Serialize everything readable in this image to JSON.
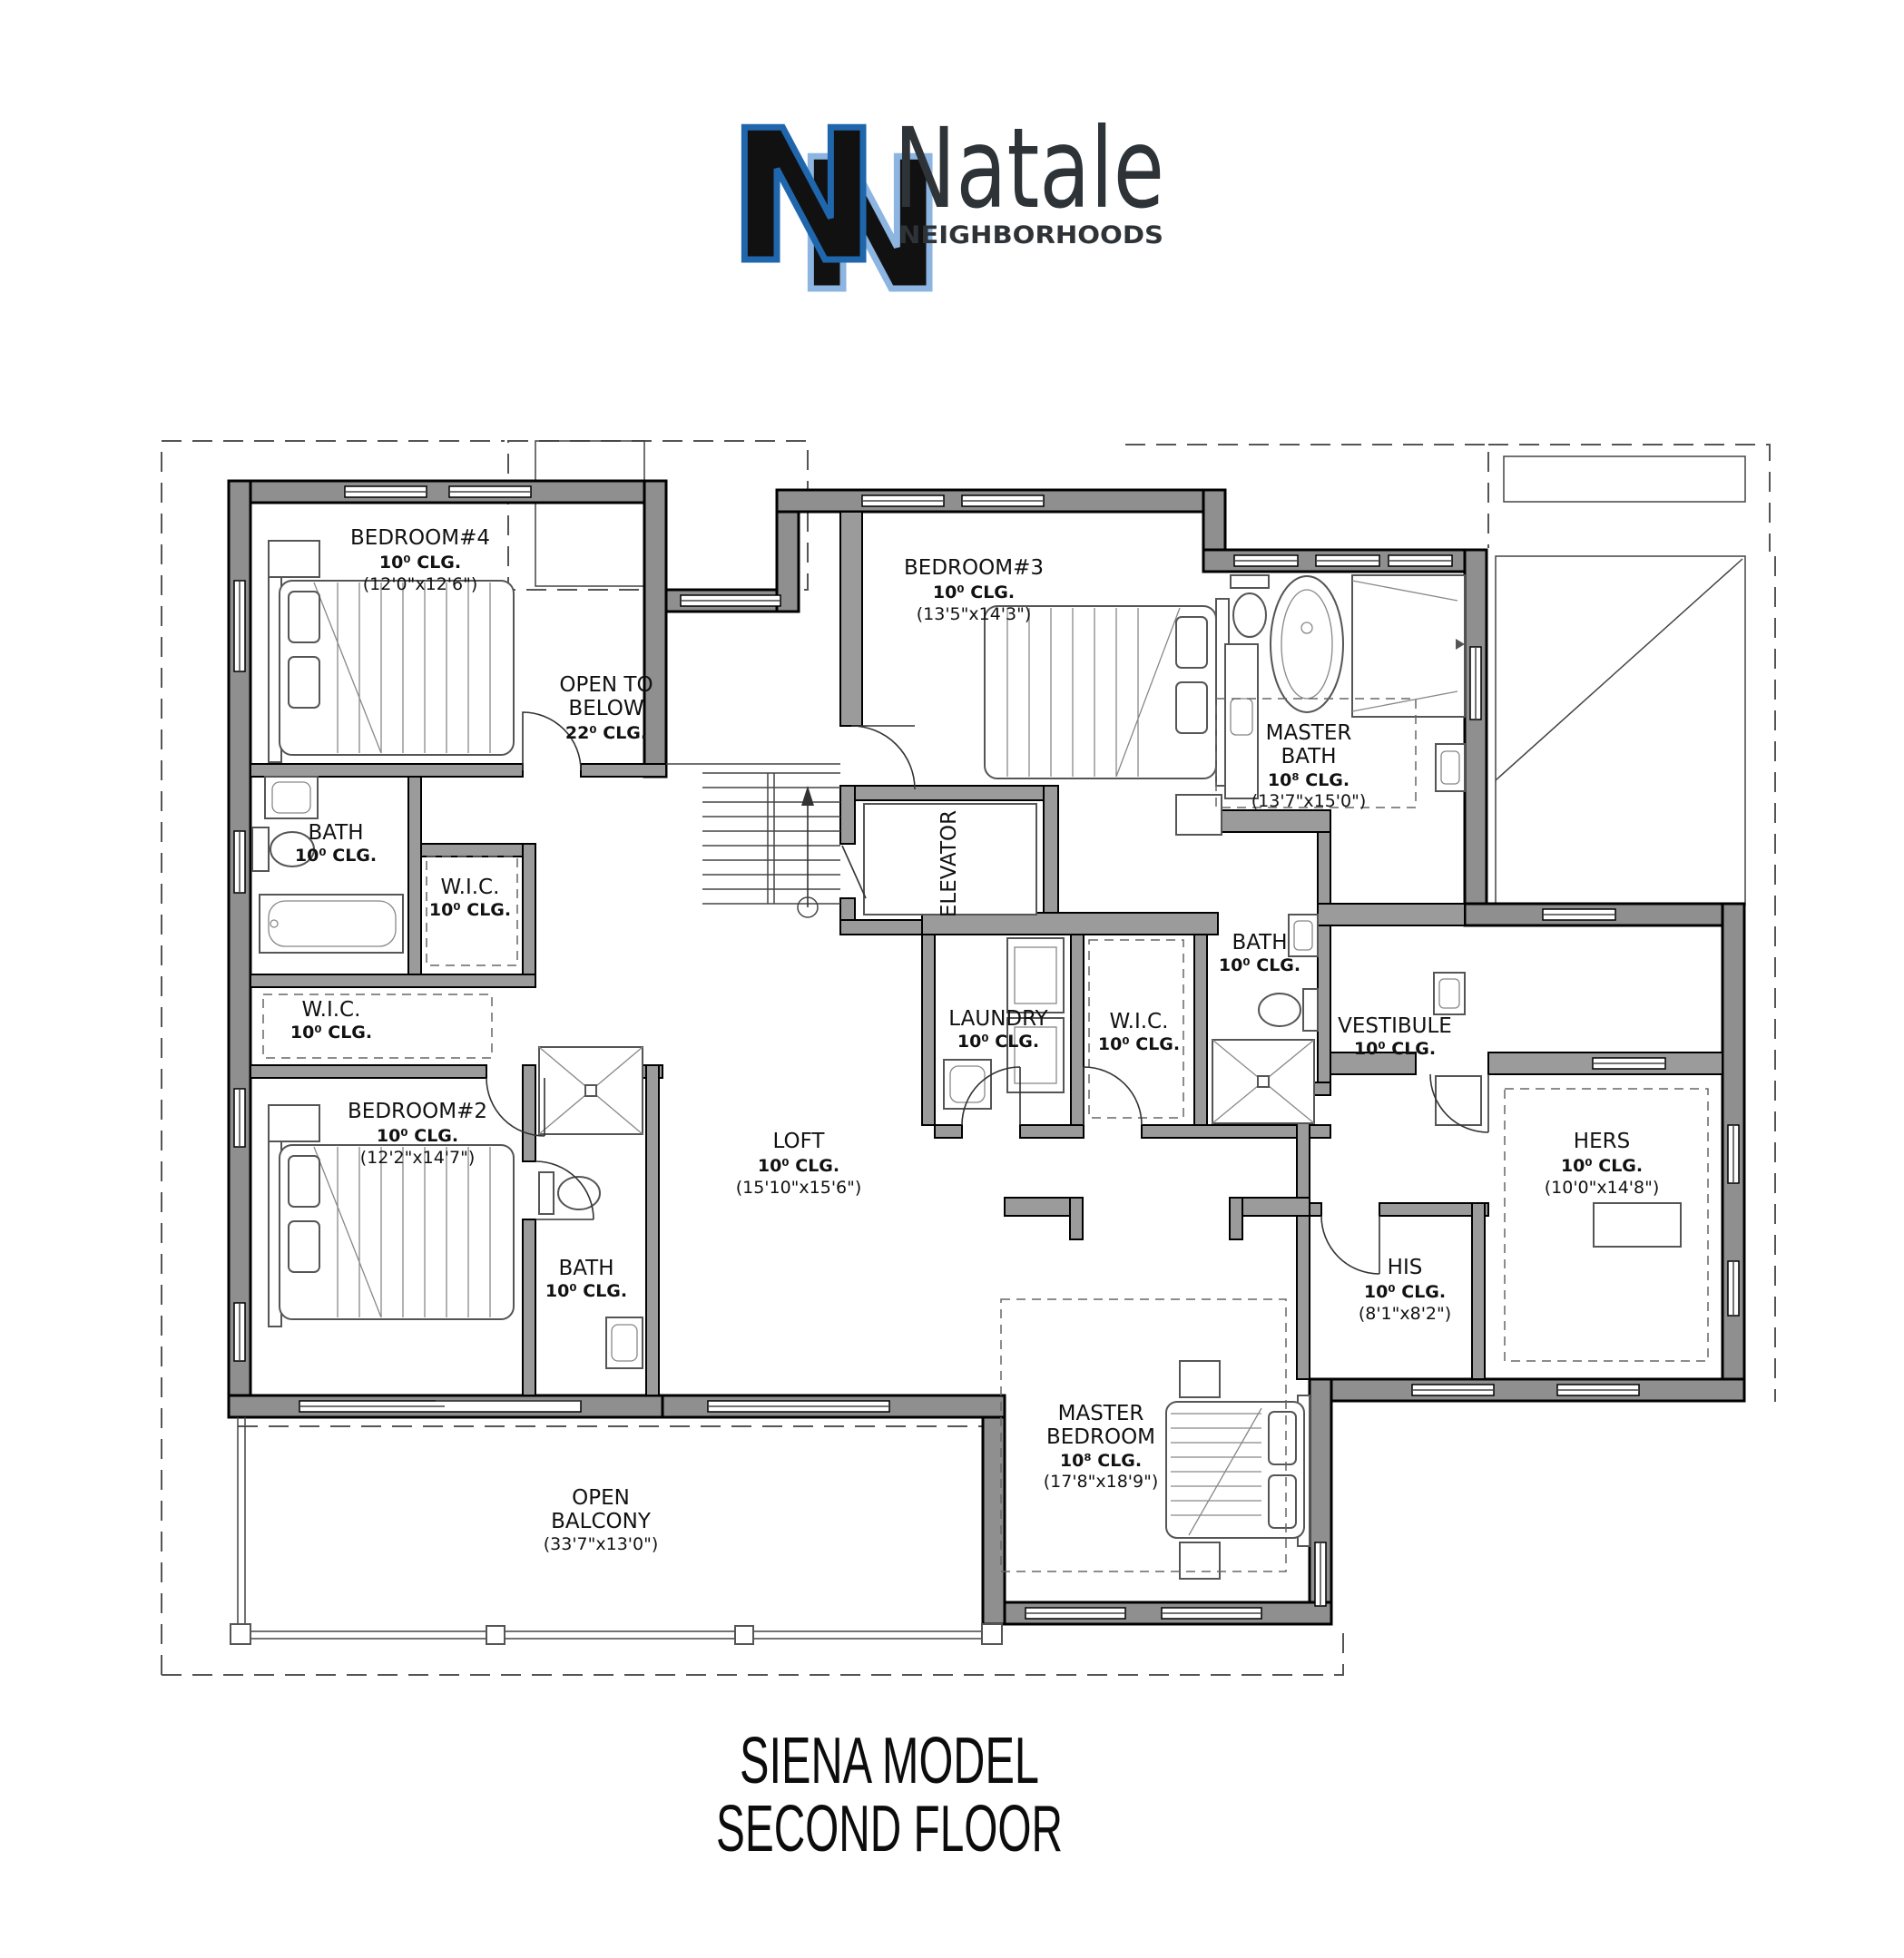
{
  "logo": {
    "monogram_letter": "N",
    "brand": "Natale",
    "subbrand": "NEIGHBORHOODS",
    "colors": {
      "dark_blue": "#1f66ad",
      "light_blue": "#8cb5e2",
      "text": "#2e3338"
    }
  },
  "plan": {
    "rooms": [
      {
        "id": "bedroom4",
        "lines": [
          "BEDROOM#4",
          "10⁰ CLG.",
          "(12'0\"x12'6\")"
        ]
      },
      {
        "id": "open-to-below",
        "lines": [
          "OPEN TO",
          "BELOW",
          "22⁰ CLG."
        ]
      },
      {
        "id": "bedroom3",
        "lines": [
          "BEDROOM#3",
          "10⁰ CLG.",
          "(13'5\"x14'3\")"
        ]
      },
      {
        "id": "master-bath",
        "lines": [
          "MASTER",
          "BATH",
          "10⁸ CLG.",
          "(13'7\"x15'0\")"
        ]
      },
      {
        "id": "bath-left",
        "lines": [
          "BATH",
          "10⁰ CLG."
        ]
      },
      {
        "id": "wic-mid",
        "lines": [
          "W.I.C.",
          "10⁰ CLG."
        ]
      },
      {
        "id": "wic-left",
        "lines": [
          "W.I.C.",
          "10⁰ CLG."
        ]
      },
      {
        "id": "bedroom2",
        "lines": [
          "BEDROOM#2",
          "10⁰ CLG.",
          "(12'2\"x14'7\")"
        ]
      },
      {
        "id": "bath-center",
        "lines": [
          "BATH",
          "10⁰ CLG."
        ]
      },
      {
        "id": "elevator",
        "lines": [
          "ELEVATOR"
        ]
      },
      {
        "id": "laundry",
        "lines": [
          "LAUNDRY",
          "10⁰ CLG."
        ]
      },
      {
        "id": "wic-right",
        "lines": [
          "W.I.C.",
          "10⁰ CLG."
        ]
      },
      {
        "id": "bath-right",
        "lines": [
          "BATH",
          "10⁰ CLG."
        ]
      },
      {
        "id": "vestibule",
        "lines": [
          "VESTIBULE",
          "10⁰ CLG."
        ]
      },
      {
        "id": "hers",
        "lines": [
          "HERS",
          "10⁰ CLG.",
          "(10'0\"x14'8\")"
        ]
      },
      {
        "id": "his",
        "lines": [
          "HIS",
          "10⁰ CLG.",
          "(8'1\"x8'2\")"
        ]
      },
      {
        "id": "loft",
        "lines": [
          "LOFT",
          "10⁰ CLG.",
          "(15'10\"x15'6\")"
        ]
      },
      {
        "id": "master-bedroom",
        "lines": [
          "MASTER",
          "BEDROOM",
          "10⁸ CLG.",
          "(17'8\"x18'9\")"
        ]
      },
      {
        "id": "open-balcony",
        "lines": [
          "OPEN",
          "BALCONY",
          "(33'7\"x13'0\")"
        ]
      }
    ]
  },
  "title": {
    "line1": "SIENA MODEL",
    "line2": "SECOND FLOOR"
  }
}
